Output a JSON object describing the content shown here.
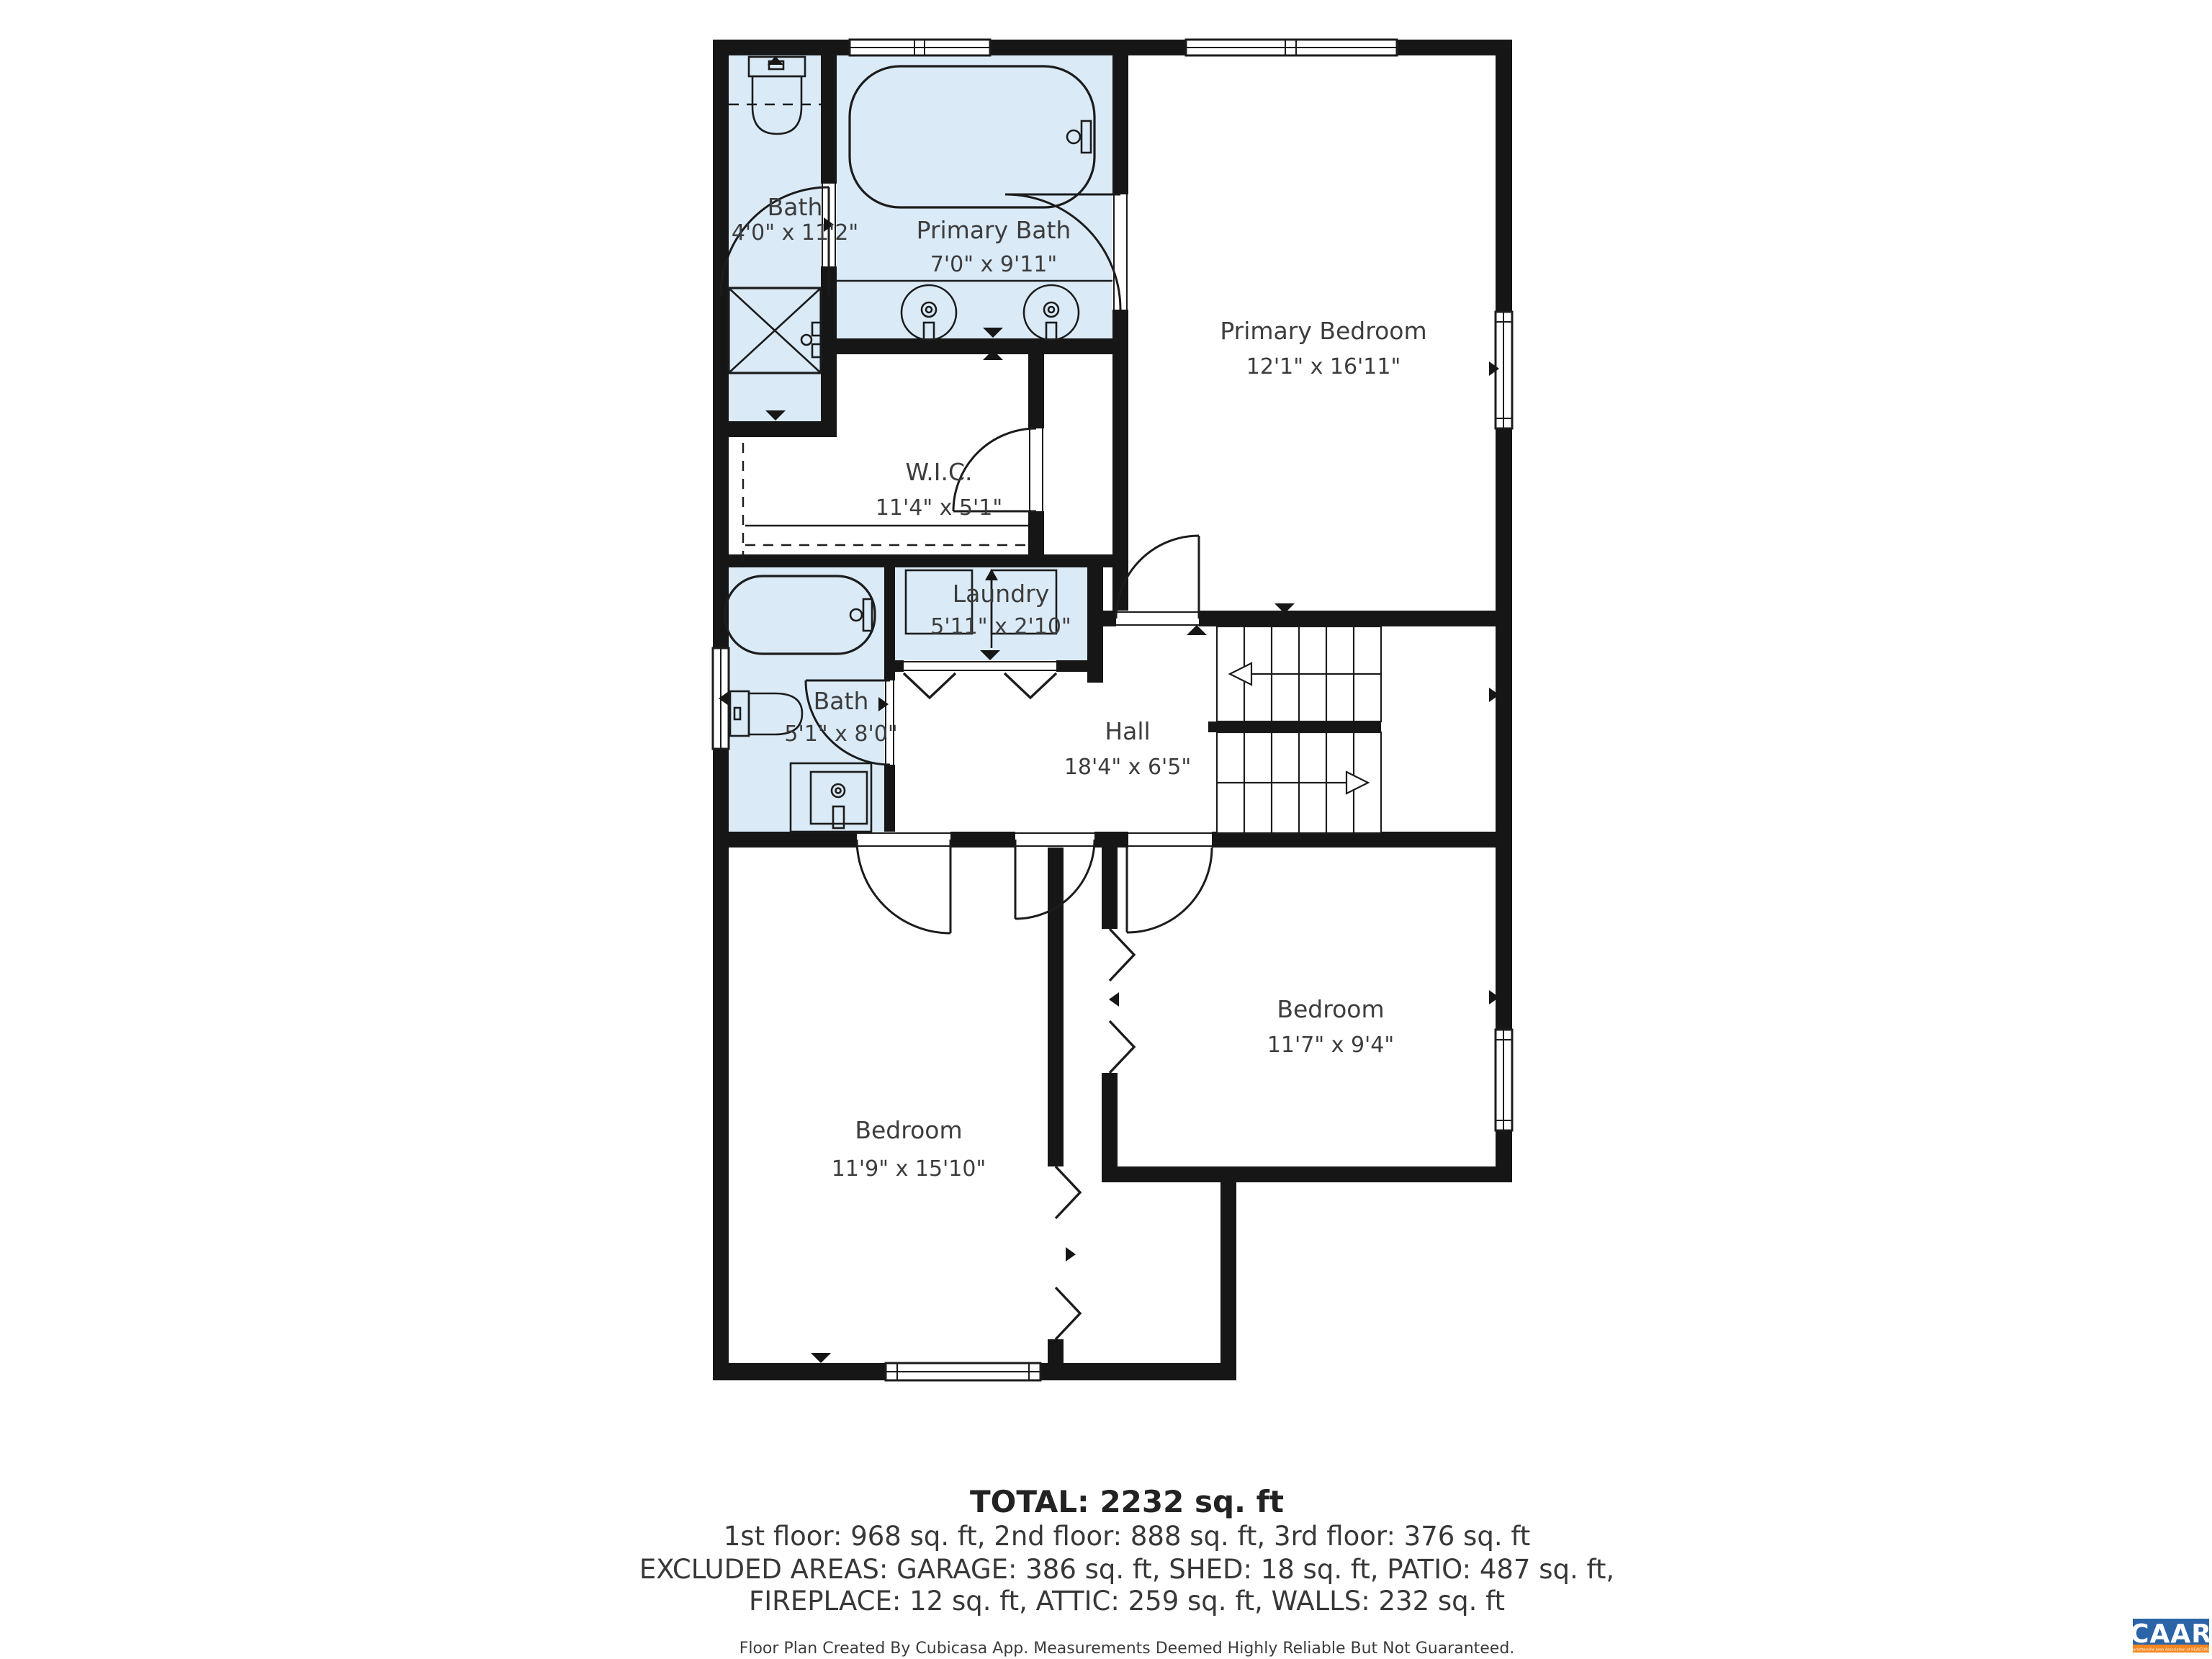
{
  "floor_plan": {
    "rooms": [
      {
        "id": "bath-1",
        "name": "Bath",
        "dims": "4'0\" x 11'2\"",
        "highlighted": true
      },
      {
        "id": "primary-bath",
        "name": "Primary Bath",
        "dims": "7'0\" x 9'11\"",
        "highlighted": true
      },
      {
        "id": "primary-bedroom",
        "name": "Primary Bedroom",
        "dims": "12'1\" x 16'11\"",
        "highlighted": false
      },
      {
        "id": "wic",
        "name": "W.I.C.",
        "dims": "11'4\" x 5'1\"",
        "highlighted": false
      },
      {
        "id": "laundry",
        "name": "Laundry",
        "dims": "5'11\" x 2'10\"",
        "highlighted": true
      },
      {
        "id": "bath-2",
        "name": "Bath",
        "dims": "5'1\" x 8'0\"",
        "highlighted": true
      },
      {
        "id": "hall",
        "name": "Hall",
        "dims": "18'4\" x 6'5\"",
        "highlighted": false
      },
      {
        "id": "bedroom-left",
        "name": "Bedroom",
        "dims": "11'9\" x 15'10\"",
        "highlighted": false
      },
      {
        "id": "bedroom-right",
        "name": "Bedroom",
        "dims": "11'7\" x 9'4\"",
        "highlighted": false
      }
    ],
    "colors": {
      "wall": "#161616",
      "bath_fill": "#daeaf7",
      "floor_fill": "#ffffff"
    }
  },
  "summary": {
    "total": "TOTAL: 2232 sq. ft",
    "floors": "1st floor: 968 sq. ft, 2nd floor: 888 sq. ft, 3rd floor: 376 sq. ft",
    "excluded_1": "EXCLUDED AREAS: GARAGE: 386 sq. ft, SHED: 18 sq. ft, PATIO: 487 sq. ft,",
    "excluded_2": "FIREPLACE: 12 sq. ft, ATTIC: 259 sq. ft, WALLS: 232 sq. ft"
  },
  "footer": {
    "disclaimer": "Floor Plan Created By Cubicasa App. Measurements Deemed Highly Reliable But Not Guaranteed."
  },
  "logo": {
    "title": "CAAR",
    "subtitle": "Charlottesville Area Association of REALTORS®",
    "bg_color": "#2b64a7",
    "accent_color": "#f6861f"
  }
}
